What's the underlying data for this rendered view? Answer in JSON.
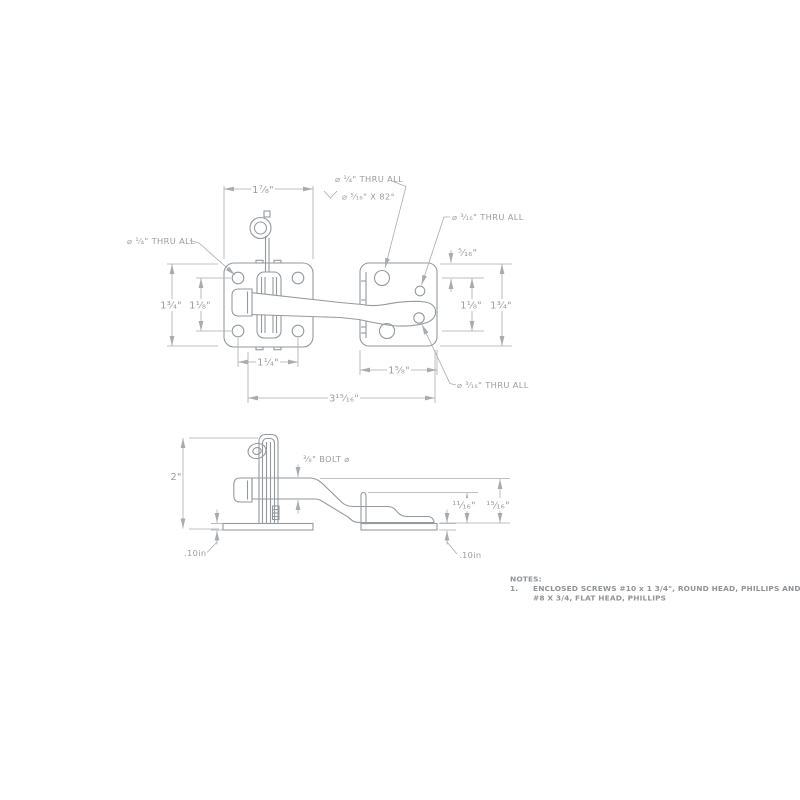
{
  "drawing": {
    "background": "#ffffff",
    "object_line_color": "#939a9e",
    "dimension_line_color": "#a7acb0",
    "text_color": "#979da1",
    "notes_color": "#8f9498"
  },
  "top_view": {
    "dims": {
      "plate_width": "1⁷⁄₈\"",
      "left_plate_height": "1³⁄₄\"",
      "left_hole_spacing_v": "1¹⁄₈\"",
      "left_hole_spacing_h": "1¹⁄₄\"",
      "right_plate_width": "1⁵⁄₈\"",
      "overall_length": "3¹⁵⁄₁₆\"",
      "right_edge_offset": "⁵⁄₁₆\"",
      "right_hole_spacing_v": "1¹⁄₈\"",
      "right_plate_height": "1³⁄₄\""
    },
    "callouts": {
      "left_hole": "⌀ ¹⁄₄\" THRU ALL",
      "csk_line1": "⌀ ¹⁄₄\" THRU ALL",
      "csk_line2": "⌀ ⁵⁄₁₆\" X 82°",
      "small_hole_top": "⌀ ³⁄₁₆\" THRU ALL",
      "small_hole_bottom": "⌀ ³⁄₁₆\" THRU ALL"
    }
  },
  "side_view": {
    "dims": {
      "overall_height": "2\"",
      "bolt_diameter": "³⁄₈\" BOLT ⌀",
      "thickness_left": ".10in",
      "thickness_right": ".10in",
      "keeper_height": "¹¹⁄₁₆\"",
      "bolt_centerline_height": "¹⁵⁄₁₆\""
    }
  },
  "notes": {
    "title": "NOTES:",
    "item_number": "1.",
    "line1": "ENCLOSED SCREWS #10 x 1 3/4\", ROUND HEAD, PHILLIPS AND",
    "line2": "#8 X 3/4, FLAT HEAD, PHILLIPS"
  }
}
